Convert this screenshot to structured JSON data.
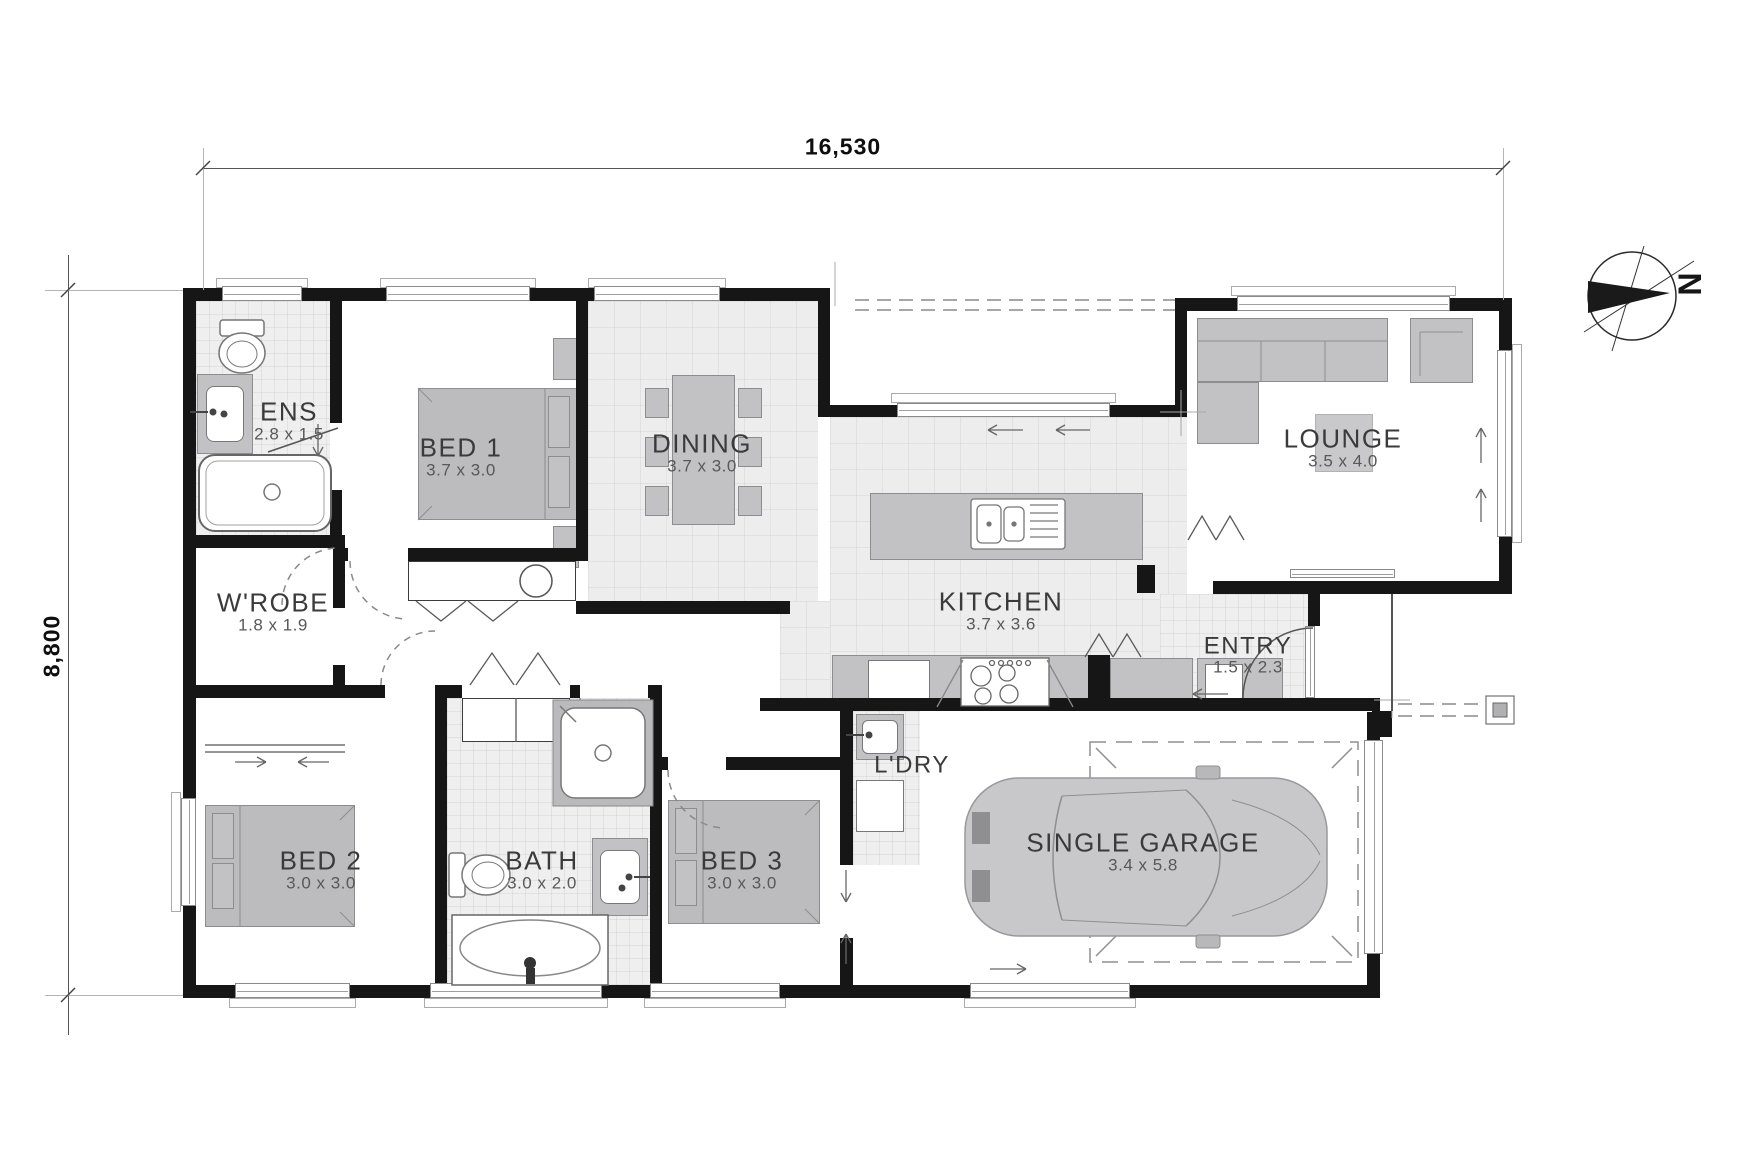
{
  "plan": {
    "dim_width": "16,530",
    "dim_height": "8,800",
    "compass_label": "N",
    "rooms": [
      {
        "name": "ENS",
        "dims": "2.8 x 1.5"
      },
      {
        "name": "BED 1",
        "dims": "3.7 x 3.0"
      },
      {
        "name": "DINING",
        "dims": "3.7 x 3.0"
      },
      {
        "name": "LOUNGE",
        "dims": "3.5 x 4.0"
      },
      {
        "name": "W'ROBE",
        "dims": "1.8 x 1.9"
      },
      {
        "name": "KITCHEN",
        "dims": "3.7 x 3.6"
      },
      {
        "name": "ENTRY",
        "dims": "1.5 x 2.3"
      },
      {
        "name": "BED 2",
        "dims": "3.0 x 3.0"
      },
      {
        "name": "BATH",
        "dims": "3.0 x 2.0"
      },
      {
        "name": "BED 3",
        "dims": "3.0 x 3.0"
      },
      {
        "name": "L'DRY",
        "dims": ""
      },
      {
        "name": "SINGLE GARAGE",
        "dims": "3.4 x 5.8"
      }
    ]
  }
}
